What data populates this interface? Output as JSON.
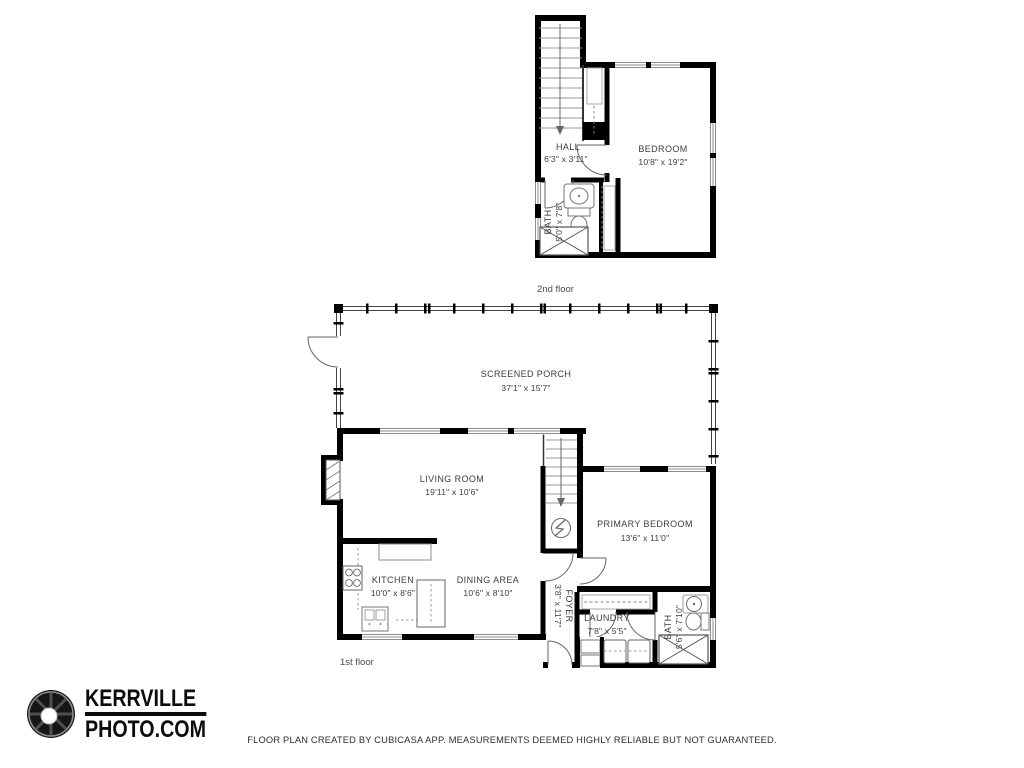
{
  "colors": {
    "wall": "#000000",
    "fixture": "#6b6b6b",
    "frame": "#8d8d8d",
    "text": "#3d3d3d"
  },
  "logo": {
    "line1": "KERRVILLE",
    "line2": "PHOTO.COM"
  },
  "footer": {
    "disclaimer": "FLOOR PLAN CREATED BY CUBICASA APP. MEASUREMENTS DEEMED HIGHLY RELIABLE BUT NOT GUARANTEED."
  },
  "floors": {
    "second": {
      "label": "2nd floor",
      "rooms": {
        "bedroom": {
          "name": "BEDROOM",
          "dims": "10'8\" x 19'2\""
        },
        "hall": {
          "name": "HALL",
          "dims": "6'3\" x 3'11\""
        },
        "bath": {
          "name": "BATH",
          "dims": "5'0\" x 7'8\""
        }
      }
    },
    "first": {
      "label": "1st floor",
      "rooms": {
        "screened_porch": {
          "name": "SCREENED PORCH",
          "dims": "37'1\" x 15'7\""
        },
        "living_room": {
          "name": "LIVING ROOM",
          "dims": "19'11\" x 10'6\""
        },
        "primary_bedroom": {
          "name": "PRIMARY BEDROOM",
          "dims": "13'6\" x 11'0\""
        },
        "kitchen": {
          "name": "KITCHEN",
          "dims": "10'0\" x 8'6\""
        },
        "dining_area": {
          "name": "DINING AREA",
          "dims": "10'6\" x 8'10\""
        },
        "foyer": {
          "name": "FOYER",
          "dims": "3'8\" x 11'7\""
        },
        "laundry": {
          "name": "LAUNDRY",
          "dims": "7'8\" x 5'5\""
        },
        "bath": {
          "name": "BATH",
          "dims": "5'6\" x 7'10\""
        }
      }
    }
  }
}
